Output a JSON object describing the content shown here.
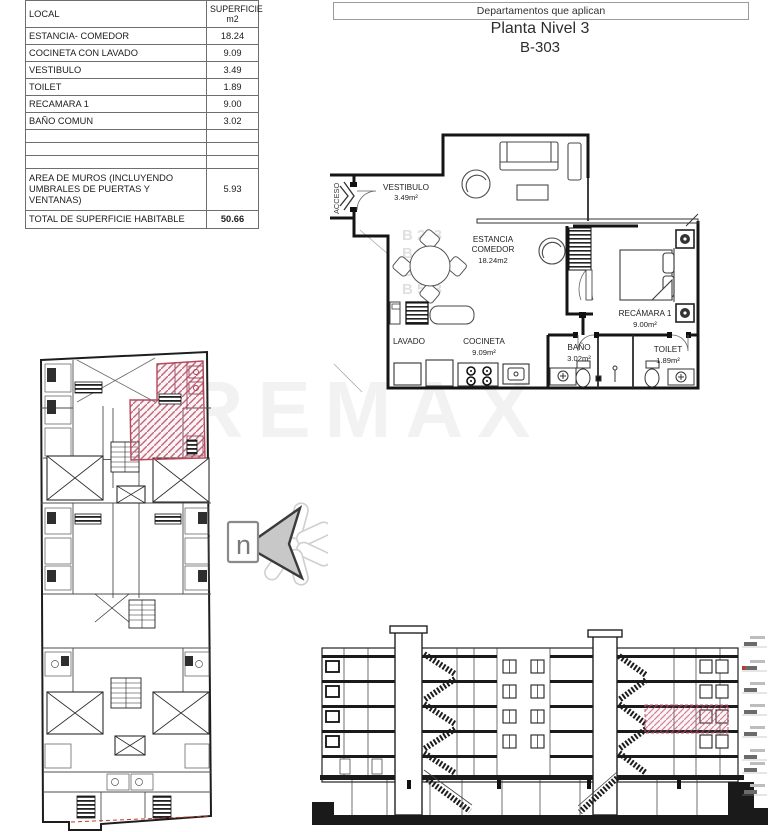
{
  "header": {
    "box_label": "Departamentos que aplican",
    "title": "Planta Nivel 3",
    "unit": "B-303"
  },
  "table": {
    "col_local": "LOCAL",
    "col_superficie": "SUPERFICIE\nm2",
    "rows": [
      {
        "local": "ESTANCIA- COMEDOR",
        "m2": "18.24"
      },
      {
        "local": "COCINETA CON LAVADO",
        "m2": "9.09"
      },
      {
        "local": "VESTIBULO",
        "m2": "3.49"
      },
      {
        "local": "TOILET",
        "m2": "1.89"
      },
      {
        "local": "RECAMARA 1",
        "m2": "9.00"
      },
      {
        "local": "BAÑO COMUN",
        "m2": "3.02"
      },
      {
        "local": "",
        "m2": ""
      },
      {
        "local": "",
        "m2": ""
      },
      {
        "local": "",
        "m2": ""
      },
      {
        "local": "AREA DE MUROS (INCLUYENDO UMBRALES DE PUERTAS Y VENTANAS)",
        "m2": "5.93"
      },
      {
        "local": "TOTAL DE SUPERFICIE HABITABLE",
        "m2": "50.66"
      }
    ]
  },
  "floorplan": {
    "acceso": "ACCESO",
    "vestibulo_name": "VESTIBULO",
    "vestibulo_area": "3.49m²",
    "estancia_line1": "ESTANCIA",
    "estancia_line2": "COMEDOR",
    "estancia_area": "18.24m2",
    "lavado": "LAVADO",
    "cocineta_name": "COCINETA",
    "cocineta_area": "9.09m²",
    "bano_name": "BAÑO",
    "bano_area": "3.02m²",
    "toilet_name": "TOILET",
    "toilet_area": "1.89m²",
    "recamara_name": "RECÁMARA 1",
    "recamara_area": "9.00m²",
    "unit_watermark": [
      "B 203",
      "B 303",
      "B 403",
      "B 503"
    ]
  },
  "north_label": "n",
  "watermark": "REMAX",
  "colors": {
    "highlight": "#b5495b",
    "line": "#1a1a1a"
  }
}
